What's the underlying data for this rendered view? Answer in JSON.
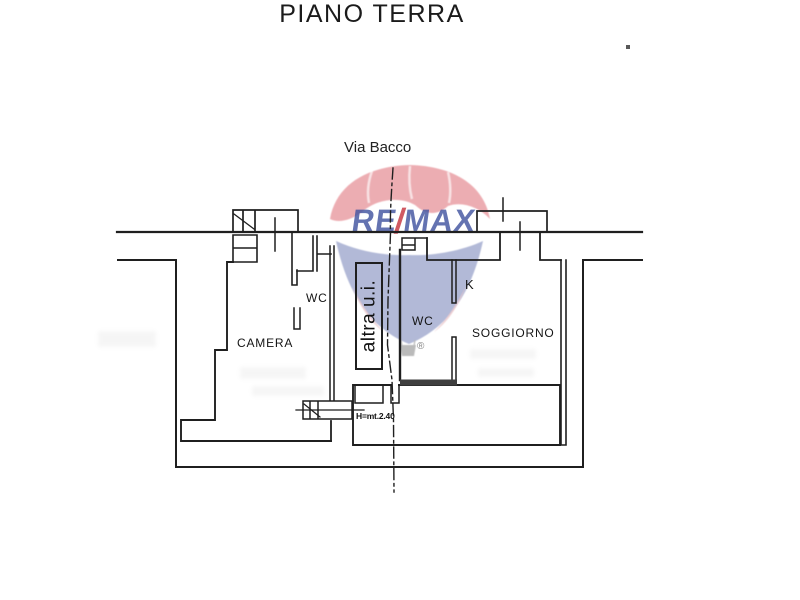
{
  "title": "PIANO TERRA",
  "street": {
    "name": "Via Bacco"
  },
  "rooms": {
    "camera": "CAMERA",
    "wc_left": "WC",
    "altra_ui": "altra u.i.",
    "wc_right": "WC",
    "kitchen": "K",
    "soggiorno": "SOGGIORNO"
  },
  "annotations": {
    "ceiling_height": "H=mt.2.40"
  },
  "watermark": {
    "re": "RE",
    "slash": "/",
    "max": "MAX",
    "registered": "®"
  },
  "colors": {
    "line": "#1f1f1f",
    "balloon_red": "#e0737c",
    "balloon_blue": "#7b87bb",
    "logo_blue": "#4254a0",
    "logo_red": "#c83c46"
  }
}
